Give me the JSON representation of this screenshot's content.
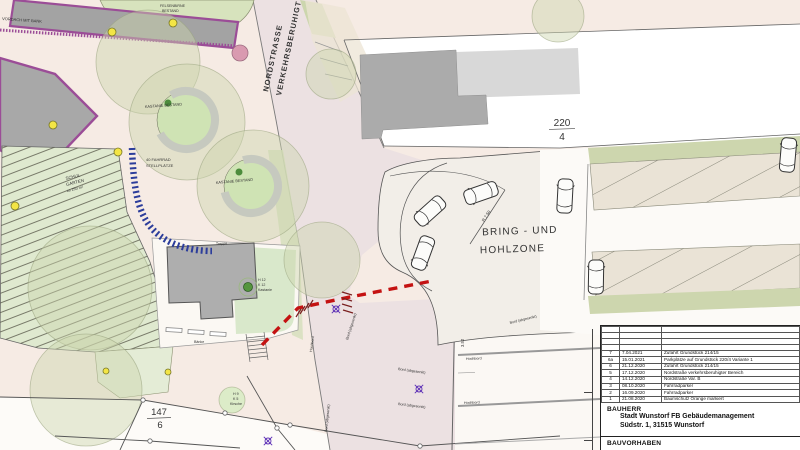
{
  "map": {
    "labels": {
      "vordach": "VORDACH MIT BANK",
      "felsenbirne_l1": "FELSENBIRNE",
      "felsenbirne_l2": "BESTAND",
      "street_l1": "NORDSTRASSE",
      "street_l2": "VERKEHRSBERUHIGT",
      "kastanie": "KASTANIE BESTAND",
      "fahrrad_l1": "40 FAHRRAD",
      "fahrrad_l2": "STELLPLÄTZE",
      "garten_l1": "SCHUL",
      "garten_l2": "GARTEN",
      "garten_l3": "ca 250 m²",
      "treppe": "Treppe",
      "baenke": "Bänke",
      "bring_l1": "BRING - UND",
      "bring_l2": "HOHLZONE",
      "radius": "R 7.50",
      "dim": "3.52",
      "hochbord": "Hochbord",
      "bord_abgesenkt": "Bord (abgesenkt)",
      "tree1_l1": "H 12",
      "tree1_l2": "K 12",
      "tree1_l3": "Kastanie",
      "tree2_l1": "H 9",
      "tree2_l2": "K 5",
      "tree2_l3": "Kirsche",
      "parcel_top_num": "220",
      "parcel_top_den": "4",
      "parcel_bottom_num": "147",
      "parcel_bottom_den": "6"
    },
    "colors": {
      "tree_protection_red": "#c41212",
      "bike_rack_blue": "#2c3d9b",
      "building_border_purple": "#9b4d97",
      "lamp_yellow": "#f3e545",
      "green_area": "#d7e3bd",
      "road_pink": "#ece1e2"
    }
  },
  "titleblock": {
    "revisions": [
      {
        "no": "7",
        "date": "7.04.2021",
        "text": "Zufahrt Grundstück 214/15"
      },
      {
        "no": "6a",
        "date": "15.01.2021",
        "text": "Parkplätze auf Grundstück 220/4 Variante 1"
      },
      {
        "no": "6",
        "date": "21.12.2020",
        "text": "Zufahrt Grundstück 214/15"
      },
      {
        "no": "5",
        "date": "17.12.2020",
        "text": "Nordstraße verkehrsberuhigter Bereich"
      },
      {
        "no": "4",
        "date": "14.12.2020",
        "text": "Nordstraße Var. B"
      },
      {
        "no": "3",
        "date": "08.10.2020",
        "text": "Fahrradparker"
      },
      {
        "no": "2",
        "date": "16.09.2020",
        "text": "Fahrradparker"
      },
      {
        "no": "1",
        "date": "21.08.2020",
        "text": "Baumschutz Orange markiert"
      }
    ],
    "bauherr_label": "BAUHERR",
    "bauherr_line1": "Stadt Wunstorf FB Gebäudemanagement",
    "bauherr_line2": "Südstr. 1, 31515 Wunstorf",
    "bauvorhaben_label": "BAUVORHABEN"
  }
}
